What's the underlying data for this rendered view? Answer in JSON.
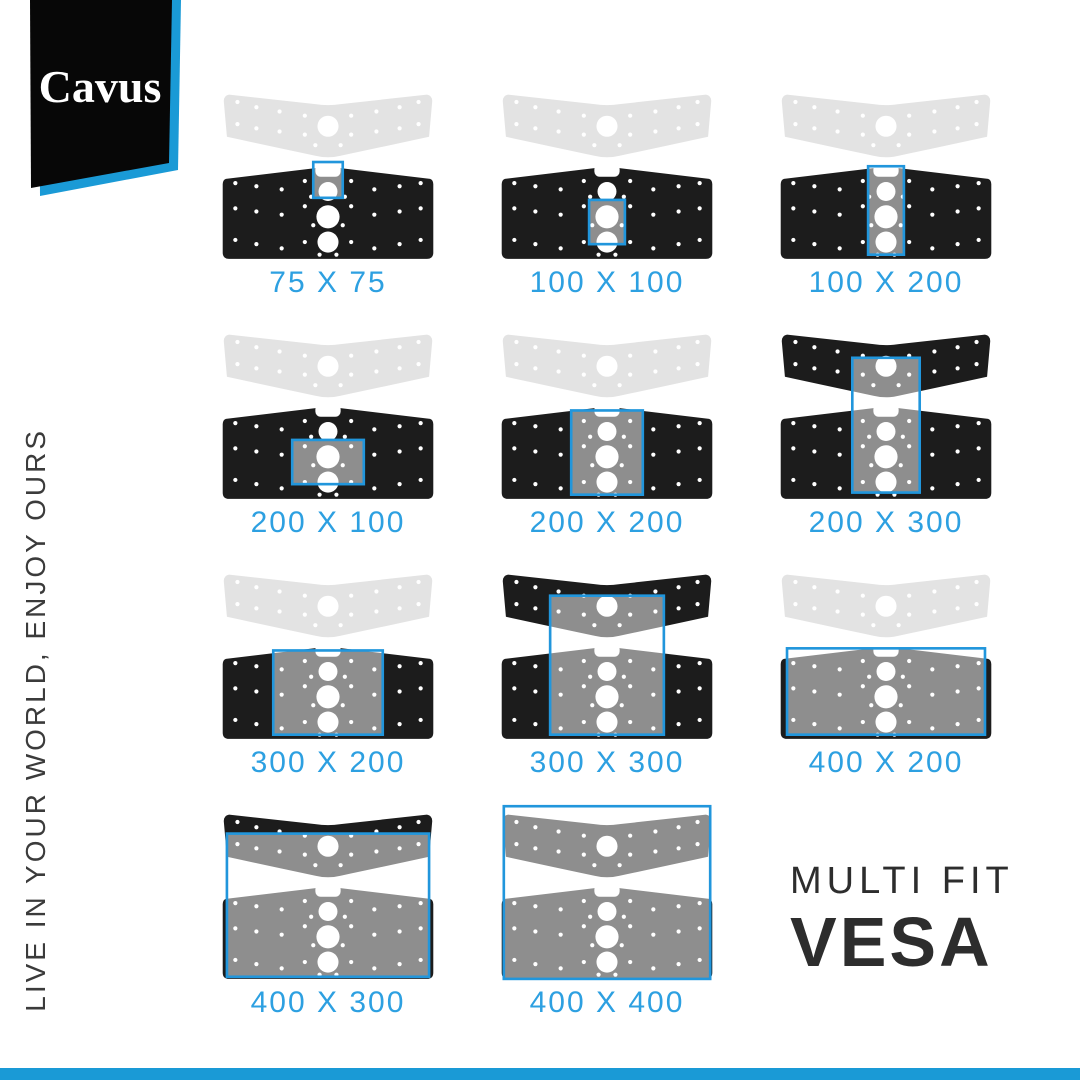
{
  "branding": {
    "logo_text": "Cavus",
    "tagline_vertical": "LIVE IN YOUR WORLD, ENJOY OURS"
  },
  "title": {
    "line1": "MULTI FIT",
    "line2": "VESA"
  },
  "colors": {
    "accent_blue": "#1a9ad6",
    "label_blue": "#2da0e1",
    "highlight_stroke": "#2196dc",
    "plate_black": "#1c1c1c",
    "plate_gray": "#e3e3e3",
    "logo_black": "#070707",
    "text_dark": "#2d2d2d"
  },
  "tiles": [
    {
      "label": "75 X 75",
      "vesa_width_mm": 75,
      "vesa_height_mm": 75,
      "top_plate": "gray",
      "highlight": {
        "x": 96,
        "y": 76,
        "w": 28,
        "h": 34
      }
    },
    {
      "label": "100 X 100",
      "vesa_width_mm": 100,
      "vesa_height_mm": 100,
      "top_plate": "gray",
      "highlight": {
        "x": 93,
        "y": 112,
        "w": 34,
        "h": 42
      }
    },
    {
      "label": "100 X 200",
      "vesa_width_mm": 100,
      "vesa_height_mm": 200,
      "top_plate": "gray",
      "highlight": {
        "x": 93,
        "y": 80,
        "w": 34,
        "h": 84
      }
    },
    {
      "label": "200 X 100",
      "vesa_width_mm": 200,
      "vesa_height_mm": 100,
      "top_plate": "gray",
      "highlight": {
        "x": 76,
        "y": 112,
        "w": 68,
        "h": 42
      }
    },
    {
      "label": "200 X 200",
      "vesa_width_mm": 200,
      "vesa_height_mm": 200,
      "top_plate": "gray",
      "highlight": {
        "x": 76,
        "y": 84,
        "w": 68,
        "h": 80
      }
    },
    {
      "label": "200 X 300",
      "vesa_width_mm": 200,
      "vesa_height_mm": 300,
      "top_plate": "black",
      "highlight": {
        "x": 78,
        "y": 34,
        "w": 64,
        "h": 128
      }
    },
    {
      "label": "300 X 200",
      "vesa_width_mm": 300,
      "vesa_height_mm": 200,
      "top_plate": "gray",
      "highlight": {
        "x": 58,
        "y": 84,
        "w": 104,
        "h": 80
      }
    },
    {
      "label": "300 X 300",
      "vesa_width_mm": 300,
      "vesa_height_mm": 300,
      "top_plate": "black",
      "highlight": {
        "x": 56,
        "y": 32,
        "w": 108,
        "h": 132
      }
    },
    {
      "label": "400 X 200",
      "vesa_width_mm": 400,
      "vesa_height_mm": 200,
      "top_plate": "gray",
      "highlight": {
        "x": 16,
        "y": 82,
        "w": 188,
        "h": 82
      }
    },
    {
      "label": "400 X 300",
      "vesa_width_mm": 400,
      "vesa_height_mm": 300,
      "top_plate": "black",
      "highlight": {
        "x": 14,
        "y": 30,
        "w": 192,
        "h": 136
      }
    },
    {
      "label": "400 X 400",
      "vesa_width_mm": 400,
      "vesa_height_mm": 400,
      "top_plate": "black",
      "highlight": {
        "x": 12,
        "y": 4,
        "w": 196,
        "h": 164
      }
    }
  ]
}
